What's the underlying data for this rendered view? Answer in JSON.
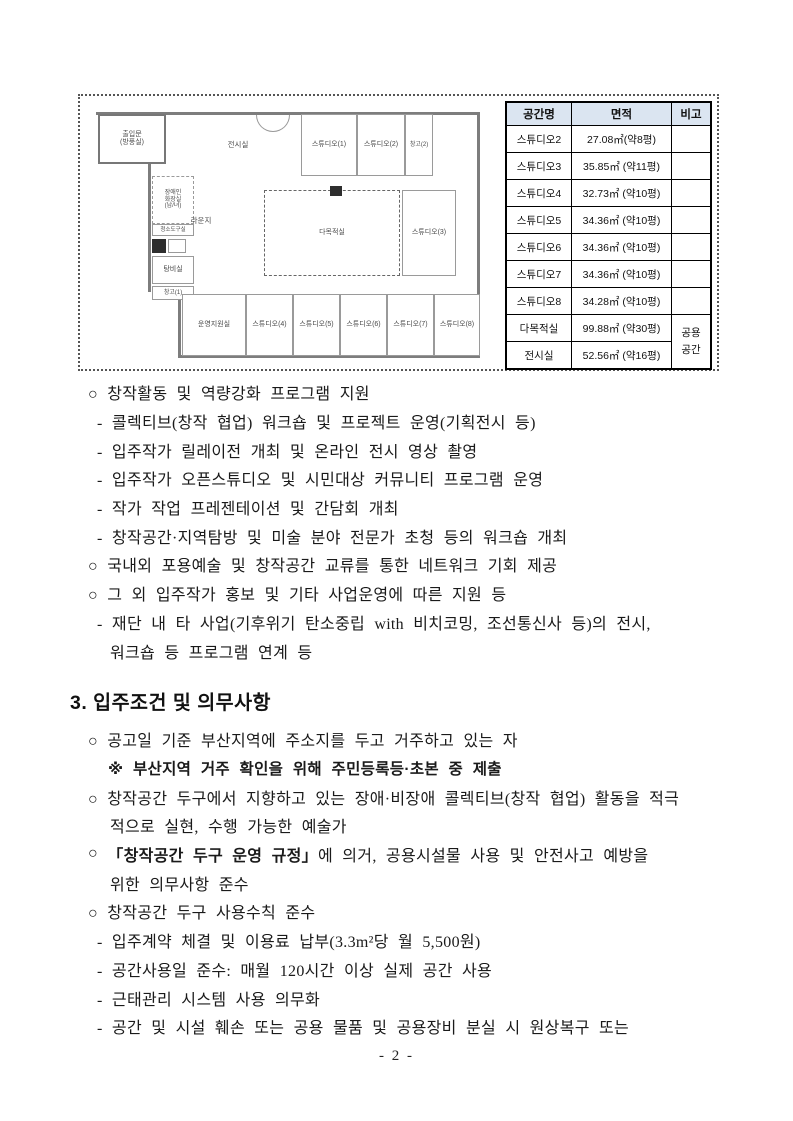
{
  "figure": {
    "floorplan": {
      "rooms": {
        "entrance": "출입문\n(방풍실)",
        "exhibition": "전시실",
        "studio1": "스튜디오(1)",
        "studio2": "스튜디오(2)",
        "storage2": "창고(2)",
        "restroom": "장애인\n화장실\n(남/녀)",
        "cleaning": "청소도구실",
        "lounge": "라운지",
        "pantry": "탕비실",
        "storage1": "창고(1)",
        "multipurpose": "다목적실",
        "studio3": "스튜디오(3)",
        "ops": "운영지원실",
        "studio4": "스튜디오(4)",
        "studio5": "스튜디오(5)",
        "studio6": "스튜디오(6)",
        "studio7": "스튜디오(7)",
        "studio8": "스튜디오(8)"
      }
    },
    "table": {
      "headers": [
        "공간명",
        "면적",
        "비고"
      ],
      "rows": [
        [
          "스튜디오2",
          "27.08㎡(약8평)",
          ""
        ],
        [
          "스튜디오3",
          "35.85㎡ (약11평)",
          ""
        ],
        [
          "스튜디오4",
          "32.73㎡ (약10평)",
          ""
        ],
        [
          "스튜디오5",
          "34.36㎡ (약10평)",
          ""
        ],
        [
          "스튜디오6",
          "34.36㎡ (약10평)",
          ""
        ],
        [
          "스튜디오7",
          "34.36㎡ (약10평)",
          ""
        ],
        [
          "스튜디오8",
          "34.28㎡ (약10평)",
          ""
        ],
        [
          "다목적실",
          "99.88㎡ (약30평)"
        ],
        [
          "전시실",
          "52.56㎡ (약16평)"
        ]
      ],
      "span_note": "공용\n공간",
      "header_bg": "#dbe5f1"
    }
  },
  "content": {
    "sec2": {
      "lines": [
        {
          "text": "○ 창작활동 및 역량강화 프로그램 지원"
        },
        {
          "text": "- 콜렉티브(창작 협업) 워크숍 및 프로젝트 운영(기획전시 등)"
        },
        {
          "text": "- 입주작가 릴레이전 개최 및 온라인 전시 영상 촬영"
        },
        {
          "text": "- 입주작가 오픈스튜디오 및 시민대상 커뮤니티 프로그램 운영"
        },
        {
          "text": "- 작가 작업 프레젠테이션 및 간담회 개최"
        },
        {
          "text": "- 창작공간·지역탐방 및 미술 분야 전문가 초청 등의 워크숍 개최"
        },
        {
          "text": "○ 국내외 포용예술 및 창작공간 교류를 통한 네트워크 기회 제공"
        },
        {
          "text": "○ 그 외 입주작가 홍보 및 기타 사업운영에 따른 지원 등"
        },
        {
          "text": "- 재단 내 타 사업(기후위기 탄소중립 with 비치코밍, 조선통신사 등)의 전시,"
        },
        {
          "text": "워크숍 등 프로그램 연계 등"
        }
      ]
    },
    "sec3": {
      "heading": "3. 입주조건 및 의무사항",
      "lines": [
        {
          "text": "○ 공고일 기준 부산지역에 주소지를 두고 거주하고 있는 자"
        },
        {
          "text": "※ 부산지역 거주 확인을 위해 주민등록등·초본 중 제출"
        },
        {
          "text": "○ 창작공간 두구에서 지향하고 있는 장애·비장애 콜렉티브(창작 협업) 활동을 적극"
        },
        {
          "text": "적으로 실현, 수행 가능한 예술가"
        },
        {
          "segments": [
            {
              "text": "○ ",
              "bold": false
            },
            {
              "text": "「창작공간 두구 운영 규정」",
              "bold": true
            },
            {
              "text": "에 의거, 공용시설물 사용 및 안전사고 예방을",
              "bold": false
            }
          ]
        },
        {
          "text": "위한 의무사항 준수"
        },
        {
          "text": "○ 창작공간 두구 사용수칙 준수"
        },
        {
          "text": "- 입주계약 체결 및 이용료 납부(3.3m²당 월 5,500원)"
        },
        {
          "text": "- 공간사용일 준수: 매월 120시간 이상 실제 공간 사용"
        },
        {
          "text": "- 근태관리 시스템 사용 의무화"
        },
        {
          "text": "- 공간 및 시설 훼손 또는 공용 물품 및 공용장비 분실 시 원상복구 또는"
        }
      ]
    }
  },
  "page": {
    "number_label": "- 2 -"
  }
}
